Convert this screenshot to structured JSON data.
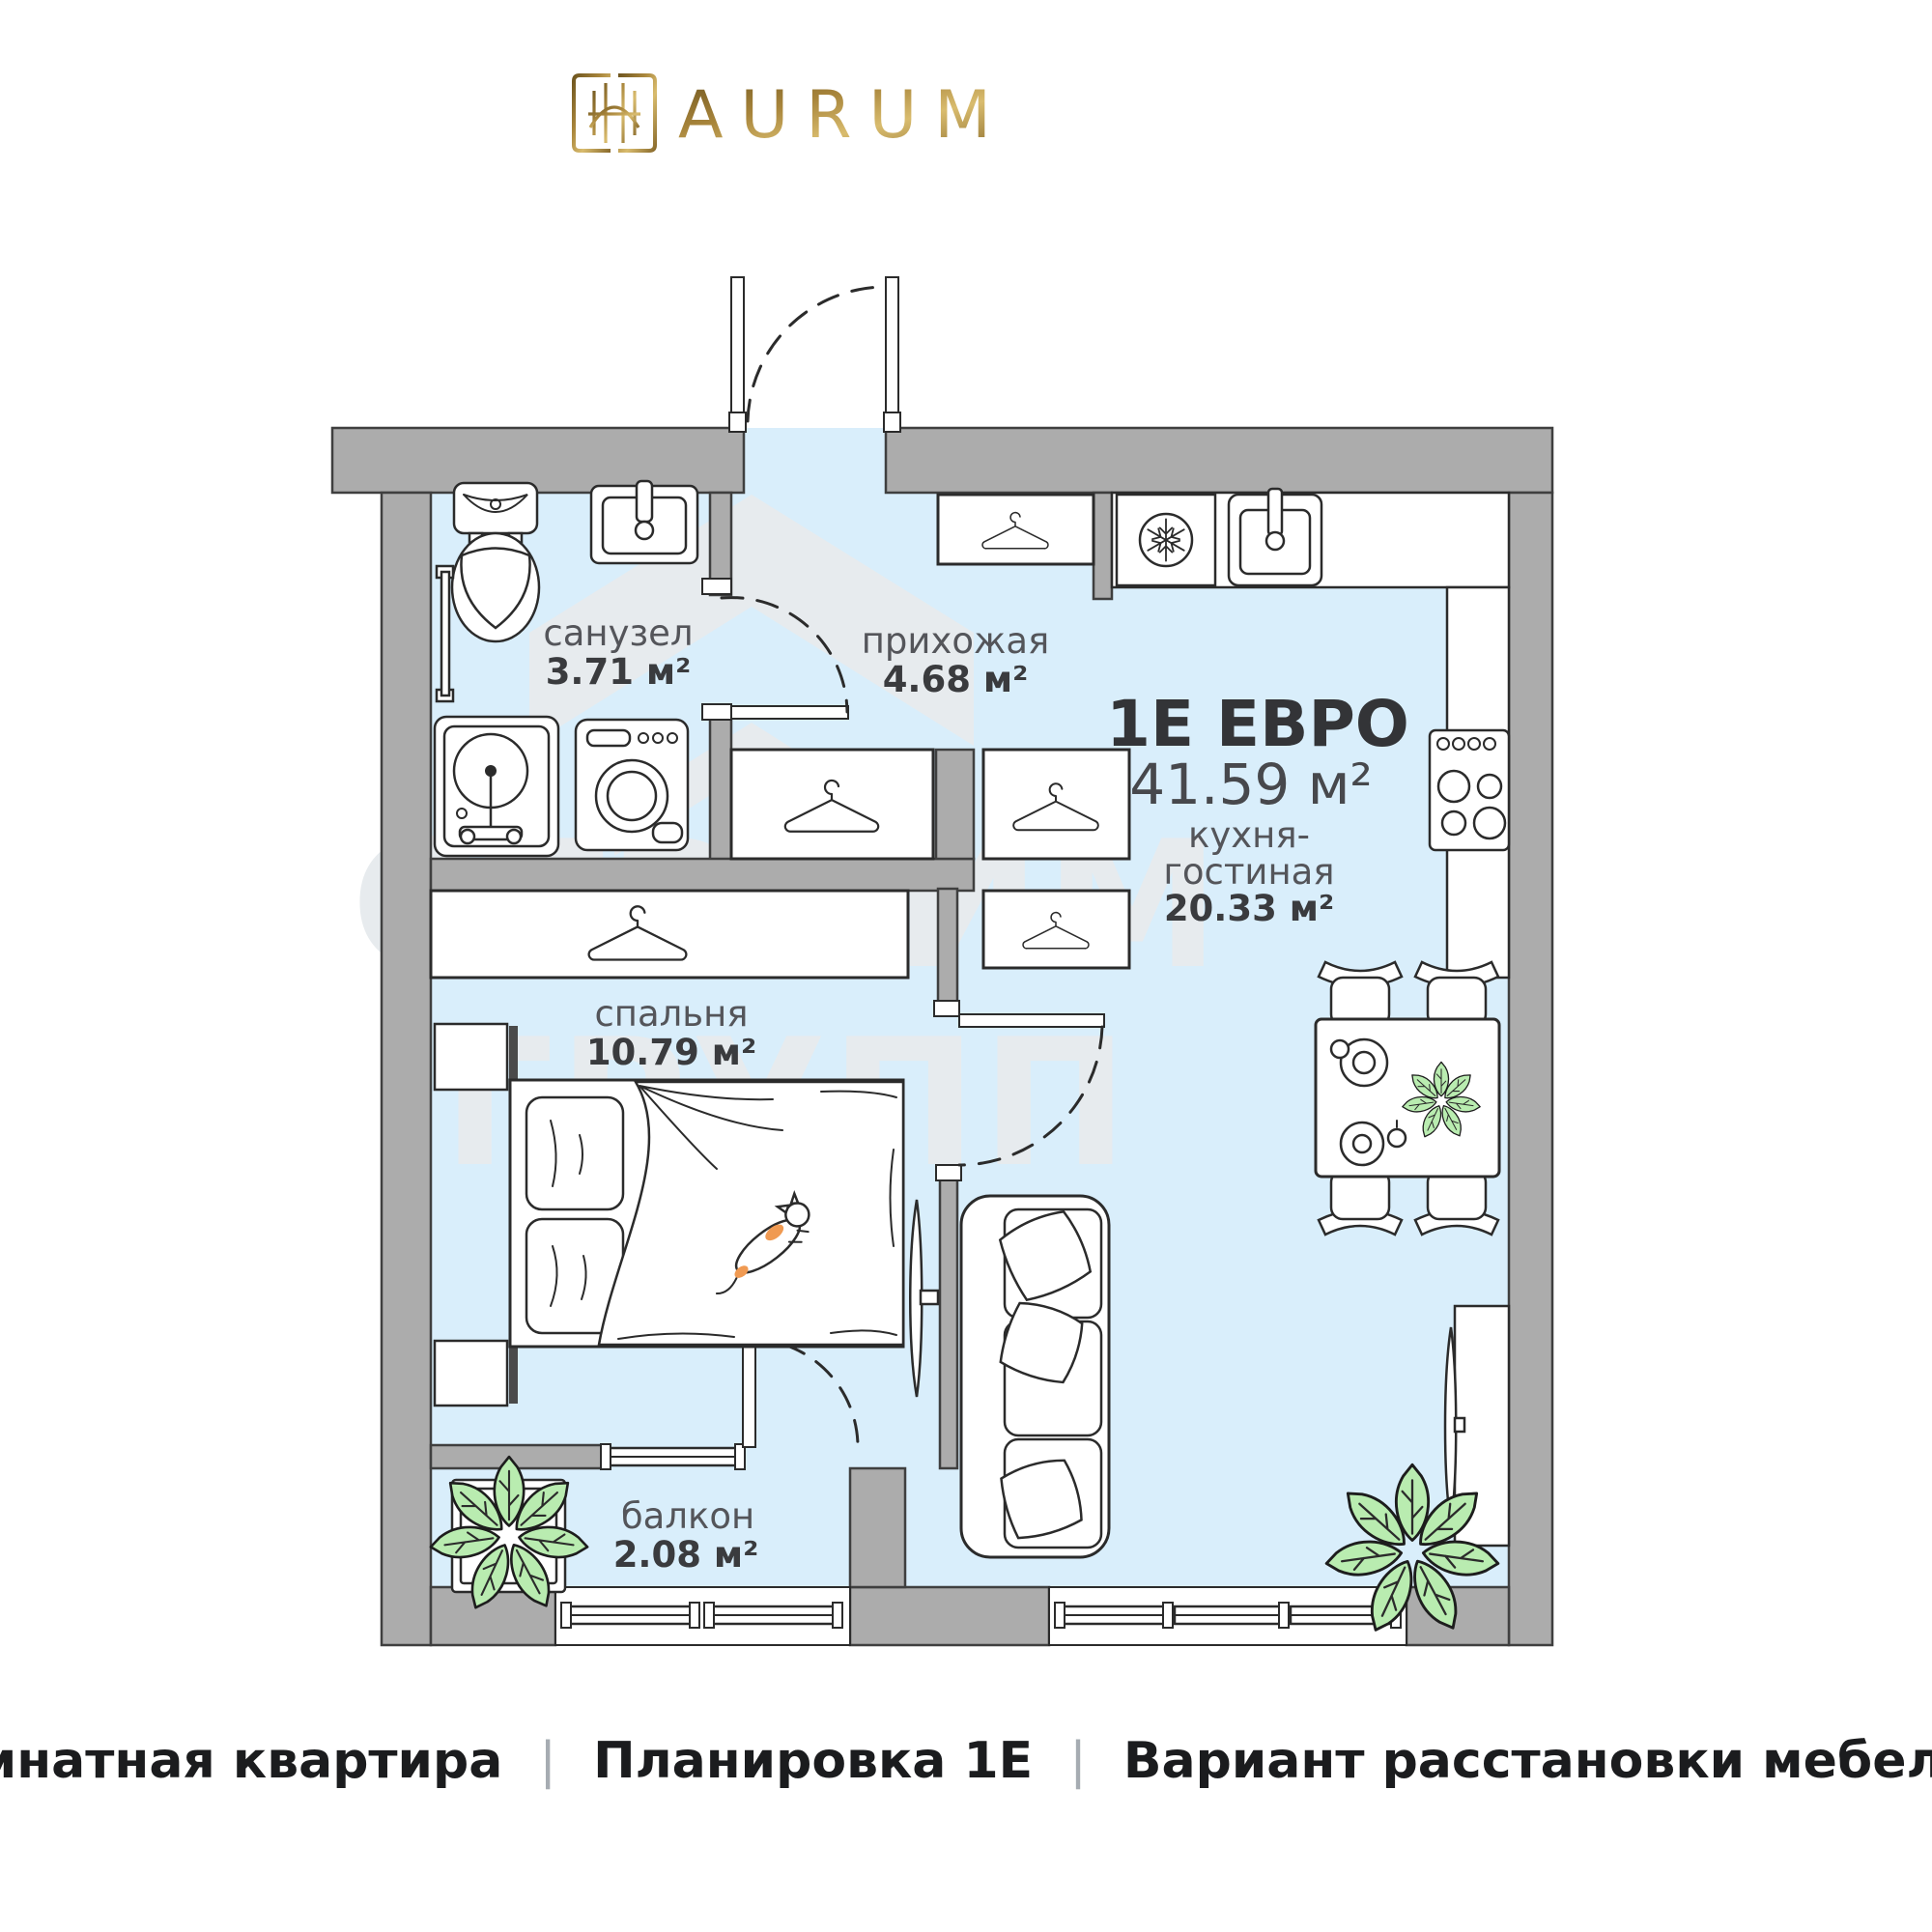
{
  "brand": {
    "name": "AURUM"
  },
  "plan": {
    "type_title": "1Е ЕВРО",
    "total_area": "41.59 м²",
    "rooms": {
      "bathroom": {
        "name": "санузел",
        "area": "3.71 м²"
      },
      "hallway": {
        "name": "прихожая",
        "area": "4.68 м²"
      },
      "kitchen_living": {
        "name_line1": "кухня-",
        "name_line2": "гостиная",
        "area": "20.33 м²"
      },
      "bedroom": {
        "name": "спальня",
        "area": "10.79 м²"
      },
      "balcony": {
        "name": "балкон",
        "area": "2.08 м²"
      }
    },
    "furniture_icons": [
      "toilet",
      "wall-sink",
      "towel-rail",
      "laundry-sink",
      "washing-machine",
      "hanger",
      "fridge-snowflake",
      "kitchen-sink",
      "stove",
      "bed",
      "cat",
      "tv-bedroom",
      "sofa",
      "dining-table",
      "chair",
      "plate",
      "plant",
      "window",
      "door-swing-arc"
    ]
  },
  "watermark": {
    "line1": "СТРОИМ",
    "line2": "ГРУПП"
  },
  "footer": {
    "segments": [
      "1-комнатная квартира",
      "Планировка 1Е",
      "Вариант расстановки мебели М1"
    ],
    "separator": "|"
  },
  "colors": {
    "floor": "#d9eefb",
    "wall": "#acacac",
    "wall_outline": "#3f3f3f",
    "gold_dark": "#6f5620",
    "gold_light": "#d9bc6e",
    "title_text": "#333437",
    "plant_green": "#b9ecb0",
    "cat_orange": "#f09a52",
    "watermark_gray": "#e7ebee"
  }
}
